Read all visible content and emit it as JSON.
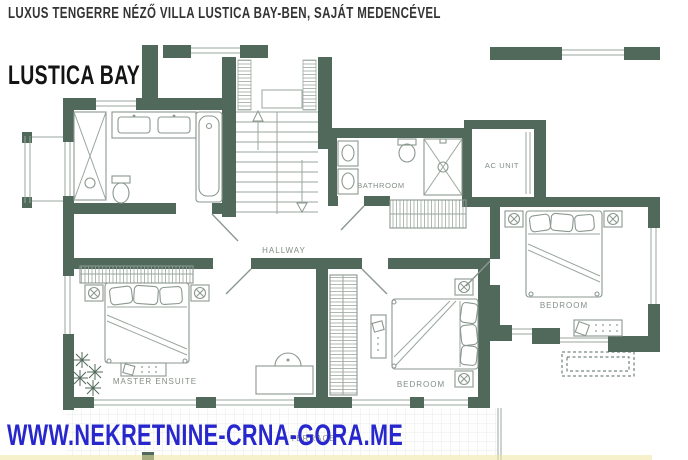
{
  "header": {
    "headline": "LUXUS TENGERRE NÉZŐ VILLA LUSTICA BAY-BEN, SAJÁT MEDENCÉVEL",
    "title": "LUSTICA BAY"
  },
  "footer": {
    "website": "WWW.NEKRETNINE-CRNA-GORA.ME"
  },
  "floorplan": {
    "rooms": {
      "hallway": "HALLWAY",
      "bathroom": "BATHROOM",
      "ac_unit": "AC UNIT",
      "bedroom_right": "BEDROOM",
      "bedroom_middle": "BEDROOM",
      "master_ensuite": "MASTER ENSUITE",
      "terrace": "TERRACE"
    },
    "colors": {
      "wall_green": "#50695b",
      "furniture_line": "#8b988f",
      "label_gray": "#828e85",
      "website_blue": "#2727cd",
      "tile_line": "#e8ece8",
      "accent_strip": "#eee6a0"
    }
  }
}
